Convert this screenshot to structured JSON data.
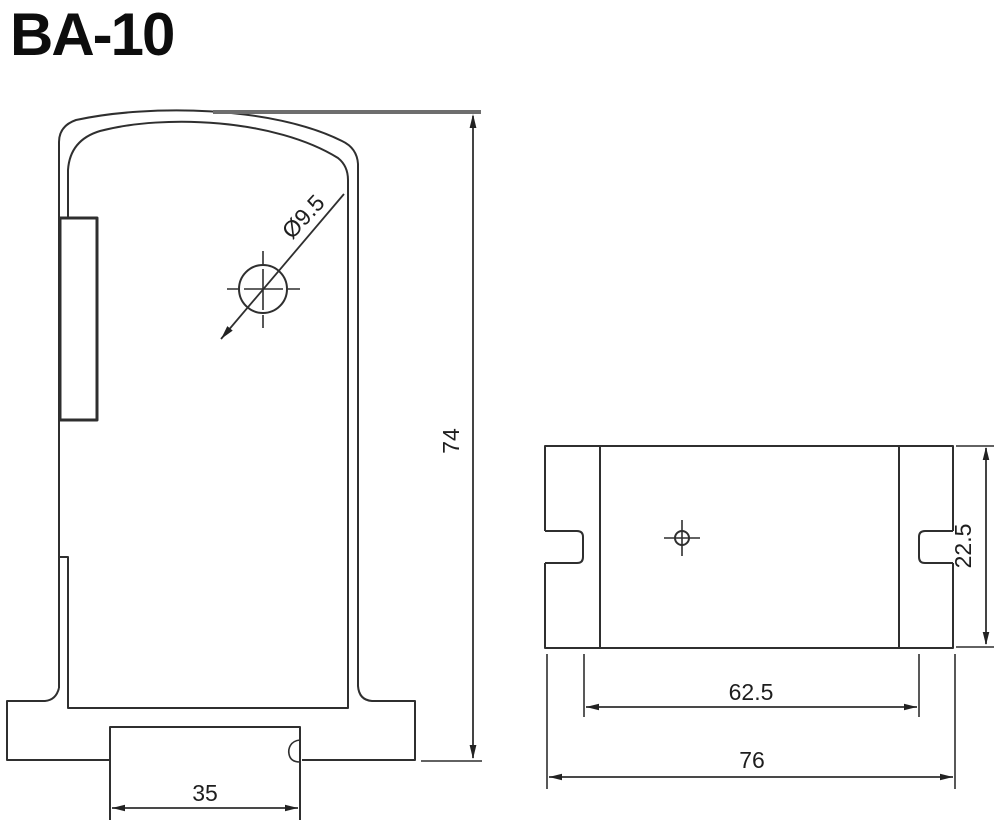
{
  "title": "BA-10",
  "colors": {
    "line": "#2f2f2f",
    "dim_text": "#1e1e1e",
    "background": "#ffffff"
  },
  "front_view": {
    "hole_diameter_label": "Ø9.5",
    "height_label": "74",
    "slot_width_label": "35"
  },
  "side_view": {
    "height_label": "22.5",
    "inner_span_label": "62.5",
    "overall_width_label": "76"
  }
}
